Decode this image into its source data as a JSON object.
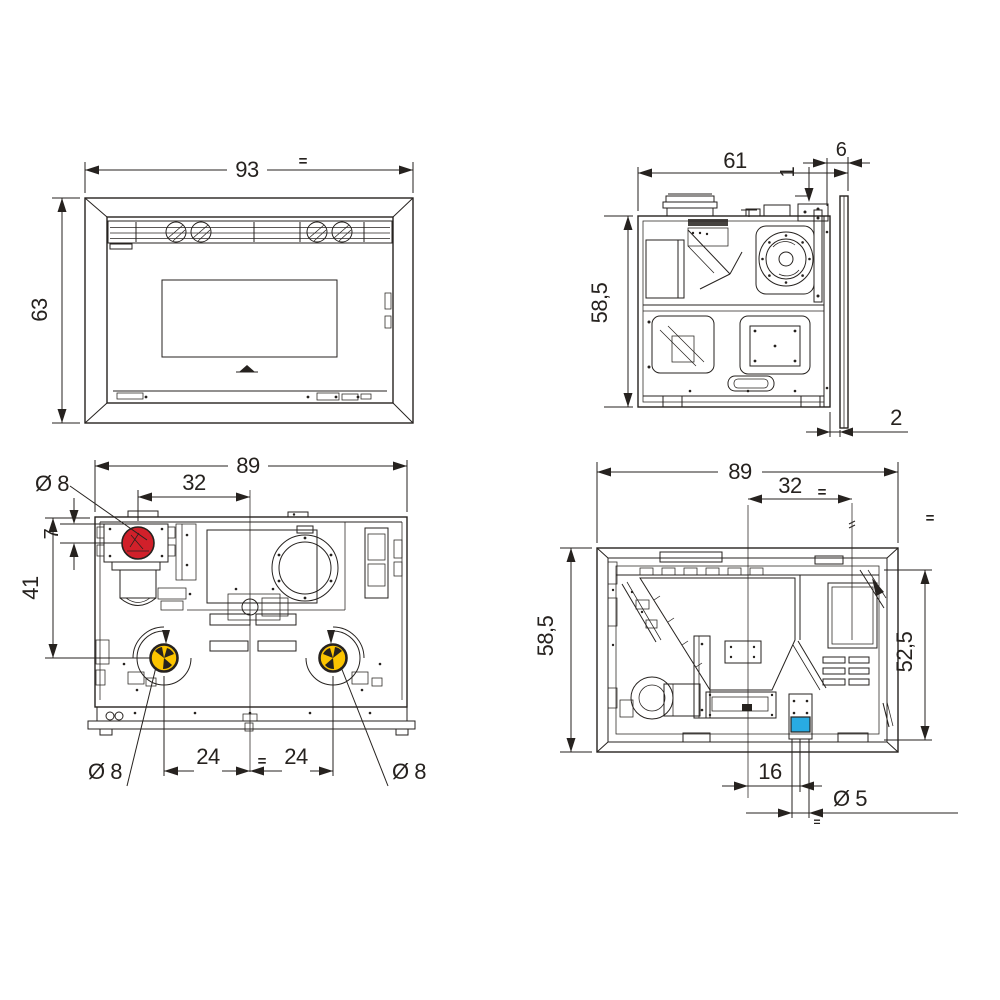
{
  "drawing": {
    "type": "technical-dimension-drawing",
    "colors": {
      "line": "#26221f",
      "red": "#d1202a",
      "yellow": "#fcc400",
      "cyan": "#29abe2",
      "background": "#ffffff"
    },
    "views": {
      "front": {
        "label": "front-view",
        "dims": {
          "width": "93",
          "width_eq": "=",
          "height": "63"
        }
      },
      "side": {
        "label": "side-view",
        "dims": {
          "depth": "61",
          "top_offset": "1",
          "frame_depth": "6",
          "height": "58,5",
          "rear_gap": "2"
        }
      },
      "rear": {
        "label": "rear-view",
        "dims": {
          "width": "89",
          "flue_offset": "32",
          "flue_diameter": "Ø 8",
          "flue_inset": "7",
          "flue_drop": "41",
          "duct_left_offset": "24",
          "duct_eq": "=",
          "duct_right_offset": "24",
          "duct_left_diameter": "Ø 8",
          "duct_right_diameter": "Ø 8"
        }
      },
      "bottom": {
        "label": "bottom-view",
        "dims": {
          "width": "89",
          "hopper_offset": "32",
          "hopper_eq": "=",
          "side_eq": "=",
          "height": "58,5",
          "inner_height": "52,5",
          "hole_offset": "16",
          "hole_diameter": "Ø 5",
          "hole_eq": "="
        }
      }
    }
  }
}
